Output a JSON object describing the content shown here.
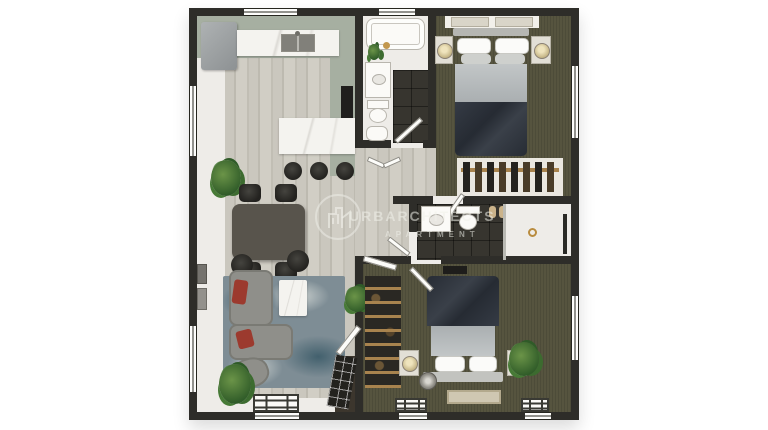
{
  "title": "apartment-floor-plan-render",
  "watermark": {
    "logo": "building-circle-icon",
    "line1": "URBARCHITECTS",
    "line2": "APARTMENT"
  },
  "palette": {
    "wall": "#2e2d29",
    "white_floor": "#eeece8",
    "sage": "#a6afa1",
    "carpet": "#56543f",
    "tile": "#37352f",
    "marble": "#f4f3ef",
    "wood_light": "#cac7be",
    "wood_dark": "#bdbab0",
    "duvet": "#2e333c",
    "blanket": "#b7bbbc",
    "sofa_gray": "#8f8f8a",
    "cushion_red": "#9c3a2e",
    "rug_blue": "#7e8d95",
    "rug_beige": "#cfc7b2",
    "plant_green": "#3e6b30",
    "table_gray": "#58544c",
    "fridge_gray": "#9b9fa0",
    "wood_rail": "#a8834e",
    "gold": "#c2974d"
  },
  "rooms": [
    {
      "name": "kitchen",
      "items": [
        "refrigerator",
        "counter-with-sink",
        "top-wall-window",
        "tall-cabinet",
        "peninsula-counter",
        "bar-stools-x3"
      ]
    },
    {
      "name": "dining-area",
      "items": [
        "dining-table",
        "dining-chairs-x4",
        "potted-plant"
      ]
    },
    {
      "name": "living-room",
      "items": [
        "sectional-sofa",
        "red-cushions-x2",
        "curved-chair",
        "coffee-table",
        "blue-area-rug",
        "ottomans-x2",
        "potted-plants-x2",
        "wall-art-x2",
        "windows"
      ]
    },
    {
      "name": "entry",
      "items": [
        "glazed-door",
        "door-leaf"
      ]
    },
    {
      "name": "bathroom-1",
      "items": [
        "bathtub",
        "vanity-sink",
        "toilet",
        "small-basin",
        "dark-tile-floor",
        "door"
      ]
    },
    {
      "name": "bedroom-1",
      "items": [
        "double-bed",
        "nightstands-x2",
        "lamps-x2",
        "headboard-art-x2",
        "wardrobe-rail-with-clothes",
        "window",
        "door"
      ]
    },
    {
      "name": "hallway",
      "items": [
        "bifold-door"
      ]
    },
    {
      "name": "bathroom-2",
      "items": [
        "vanity-sink",
        "toilet",
        "walk-in-shower",
        "shower-drain",
        "towels",
        "towel-bar",
        "door"
      ]
    },
    {
      "name": "bedroom-2",
      "items": [
        "double-bed",
        "nightstands-x2",
        "lamps-x2",
        "shelving-closet",
        "tv-console",
        "beige-rug",
        "floor-fan",
        "potted-plant",
        "windows",
        "door"
      ]
    }
  ]
}
